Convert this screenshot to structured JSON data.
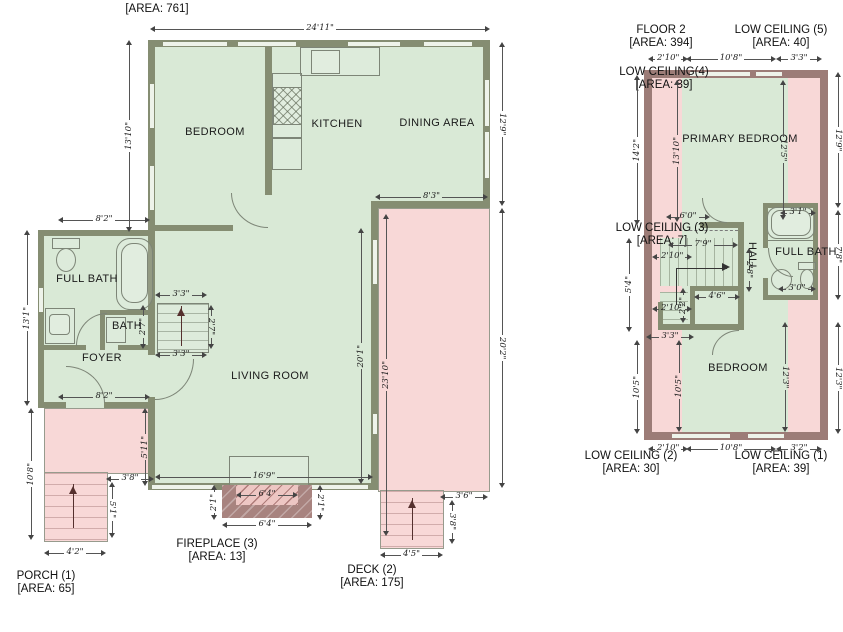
{
  "floor1": {
    "area_label": "[AREA: 761]",
    "rooms": {
      "bedroom": "BEDROOM",
      "kitchen": "KITCHEN",
      "dining": "DINING AREA",
      "living": "LIVING ROOM",
      "full_bath": "FULL BATH",
      "bath": "BATH",
      "foyer": "FOYER"
    },
    "porch": {
      "line1": "PORCH (1)",
      "line2": "[AREA: 65]"
    },
    "fireplace": {
      "line1": "FIREPLACE (3)",
      "line2": "[AREA: 13]"
    },
    "deck": {
      "line1": "DECK (2)",
      "line2": "[AREA: 175]"
    },
    "dims": {
      "top": "24'11\"",
      "left_upper": "13'10\"",
      "right_upper": "12'9\"",
      "bath_top": "8'2\"",
      "left_mid": "13'1\"",
      "foyer_bottom": "8'2\"",
      "stair_top": "3'3\"",
      "stair_bottom": "3'3\"",
      "stair_left": "2'7\"",
      "stair_right": "2'7\"",
      "deck_top": "8'3\"",
      "living_right": "20'1\"",
      "deck_inner": "23'10\"",
      "deck_right": "20'2\"",
      "living_bottom": "16'9\"",
      "fp_inner": "6'4\"",
      "fp_outer": "6'4\"",
      "fp_left": "2'1\"",
      "fp_right": "2'1\"",
      "porch_left": "10'8\"",
      "porch_step_w": "3'8\"",
      "porch_step_h": "5'1\"",
      "porch_bottom": "4'2\"",
      "porch_side": "5'11\"",
      "deck_step_top": "3'6\"",
      "deck_step_side": "3'8\"",
      "deck_step_bottom": "4'5\""
    }
  },
  "floor2": {
    "title": {
      "line1": "FLOOR 2",
      "line2": "[AREA: 394]"
    },
    "rooms": {
      "primary": "PRIMARY BEDROOM",
      "hall": "HALL",
      "full_bath": "FULL BATH",
      "bedroom": "BEDROOM"
    },
    "low_ceilings": {
      "lc5": {
        "line1": "LOW CEILING (5)",
        "line2": "[AREA: 40]"
      },
      "lc4": {
        "line1": "LOW CEILING(4)",
        "line2": "[AREA: 39]"
      },
      "lc3": {
        "line1": "LOW CEILING (3)",
        "line2": "[AREA: 7]"
      },
      "lc2": {
        "line1": "LOW CEILING (2)",
        "line2": "[AREA: 30]"
      },
      "lc1": {
        "line1": "LOW CEILING (1)",
        "line2": "[AREA: 39]"
      }
    },
    "dims": {
      "top_left": "2'10\"",
      "top_mid": "10'8\"",
      "top_right": "3'3\"",
      "left_upper_outer": "14'2\"",
      "left_upper_inner": "13'10\"",
      "right_upper_inner": "12'5\"",
      "right_upper_outer": "12'9\"",
      "stair_top": "6'0\"",
      "stair_run": "7'9\"",
      "stair_left_upper": "2'10\"",
      "stair_right": "2'8\"",
      "stair_box": "4'6\"",
      "stair_small": "2'2\"",
      "stair_left_lower": "2'10\"",
      "stair_bottom": "3'3\"",
      "left_mid": "5'4\"",
      "bath_tub": "3'1\"",
      "bath_sink": "3'0\"",
      "bath_right": "7'8\"",
      "left_lower_outer": "10'5\"",
      "left_lower_inner": "10'5\"",
      "right_lower_inner": "12'3\"",
      "right_lower_outer": "12'3\"",
      "bottom_left": "2'10\"",
      "bottom_mid": "10'8\"",
      "bottom_right": "3'2\""
    }
  }
}
